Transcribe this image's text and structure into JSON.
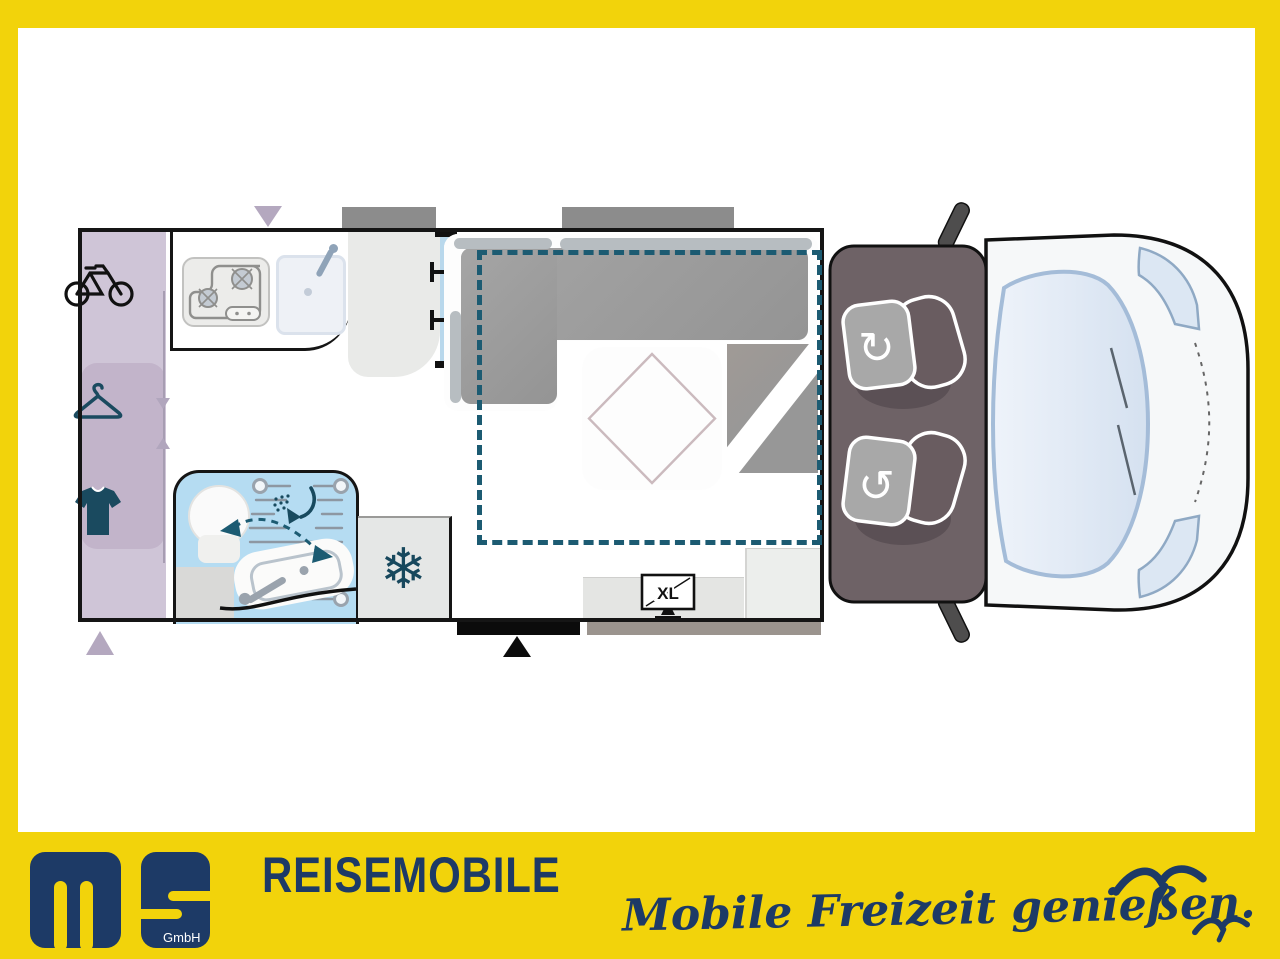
{
  "branding": {
    "gmbh": "GmbH",
    "dealer": "REISEMOBILE",
    "tagline": "Mobile Freizeit genießen.",
    "navy": "#1D3A66",
    "frame_yellow": "#F2D30B"
  },
  "floorplan": {
    "tv_label": "XL",
    "glyphs": {
      "snowflake": "❄",
      "rotate_cw": "↻",
      "rotate_ccw": "↺"
    },
    "colors": {
      "wood_floor": "#EBC89F",
      "garage_lavender": "#CFC5D7",
      "garage_lavender_inner": "#C2B4CA",
      "bathroom_blue": "#B5DCF2",
      "bed_outline_teal": "#1C5B72",
      "sofa_gray": "#9C9C9C",
      "cab_gray": "#6E6266",
      "icon_teal": "#1A4A5F",
      "wall_black": "#151515",
      "marker_lavender": "#B4A8BF"
    }
  }
}
